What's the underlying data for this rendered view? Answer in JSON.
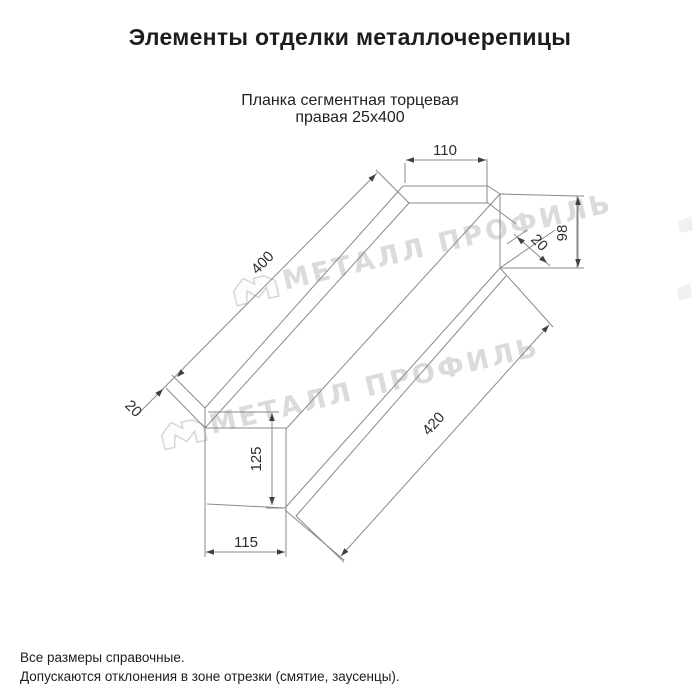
{
  "page": {
    "title": "Элементы отделки металлочерепицы"
  },
  "product": {
    "subtitle_line1": "Планка сегментная торцевая",
    "subtitle_line2": "правая 25х400"
  },
  "dimensions": {
    "top_flange_width": "110",
    "right_end_height": "98",
    "right_hem": "20",
    "top_edge_length": "400",
    "left_hem": "20",
    "bottom_edge_length": "420",
    "left_face_height": "125",
    "left_face_width": "115"
  },
  "watermark": {
    "text": "МЕТАЛЛ ПРОФИЛЬ"
  },
  "colors": {
    "drawing_line": "#8a8a8a",
    "dimension_text": "#2e2e2e",
    "watermark": "#dbdbdb"
  },
  "footer": {
    "note1": "Все размеры справочные.",
    "note2": "Допускаются отклонения в зоне отрезки (смятие, заусенцы)."
  }
}
